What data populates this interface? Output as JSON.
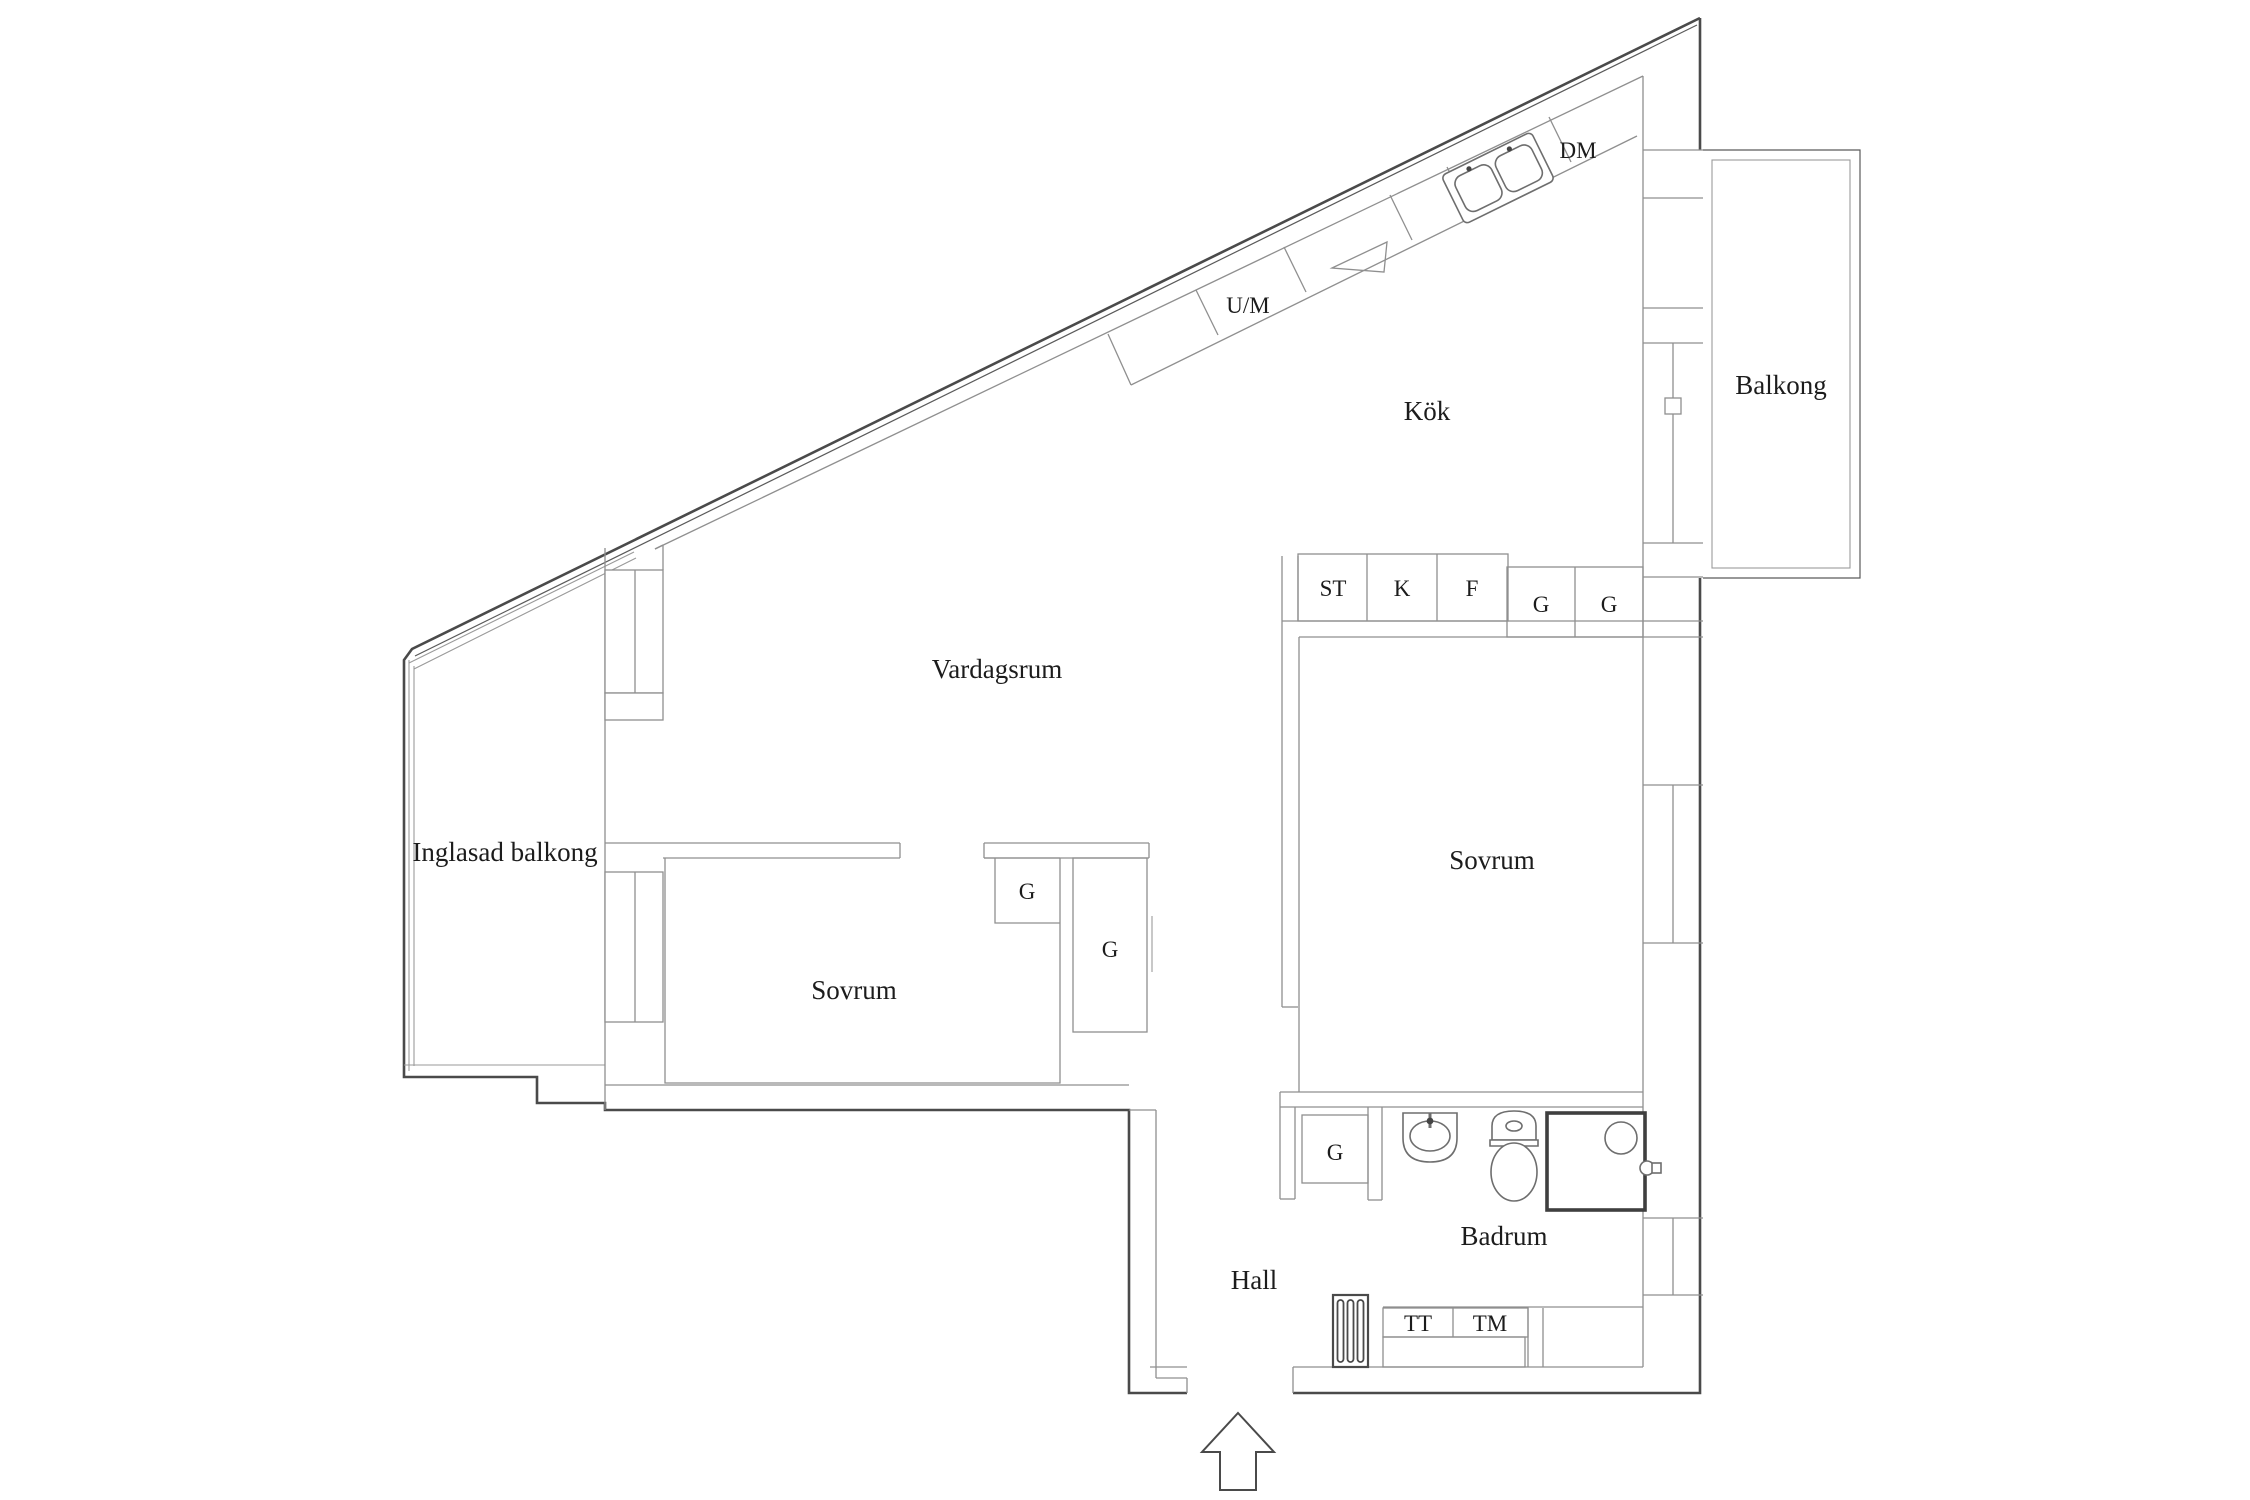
{
  "plan": {
    "type": "apartment-floor-plan",
    "language": "Swedish",
    "colors": {
      "background": "#ffffff",
      "outer_wall": "#4a4a4a",
      "inner_line": "#8f8f8f",
      "text": "#1c1c1c"
    }
  },
  "rooms": [
    {
      "id": "kok",
      "label": "Kök"
    },
    {
      "id": "vardagsrum",
      "label": "Vardagsrum"
    },
    {
      "id": "inglasad-balkong",
      "label": "Inglasad balkong"
    },
    {
      "id": "sovrum-vanster",
      "label": "Sovrum"
    },
    {
      "id": "sovrum-hoger",
      "label": "Sovrum"
    },
    {
      "id": "hall",
      "label": "Hall"
    },
    {
      "id": "badrum",
      "label": "Badrum"
    },
    {
      "id": "balkong",
      "label": "Balkong"
    }
  ],
  "appliances": [
    {
      "id": "dm",
      "label": "DM"
    },
    {
      "id": "um",
      "label": "U/M"
    },
    {
      "id": "st",
      "label": "ST"
    },
    {
      "id": "k",
      "label": "K"
    },
    {
      "id": "f",
      "label": "F"
    },
    {
      "id": "tt",
      "label": "TT"
    },
    {
      "id": "tm",
      "label": "TM"
    }
  ],
  "closets": [
    {
      "id": "g-kitchen-1",
      "label": "G"
    },
    {
      "id": "g-kitchen-2",
      "label": "G"
    },
    {
      "id": "g-bedroom-small",
      "label": "G"
    },
    {
      "id": "g-bedroom-tall",
      "label": "G"
    },
    {
      "id": "g-badrum",
      "label": "G"
    }
  ],
  "symbols": {
    "entrance_arrow": "up-arrow",
    "fixtures": [
      "double-sink",
      "stove",
      "washbasin",
      "toilet",
      "shower"
    ]
  }
}
